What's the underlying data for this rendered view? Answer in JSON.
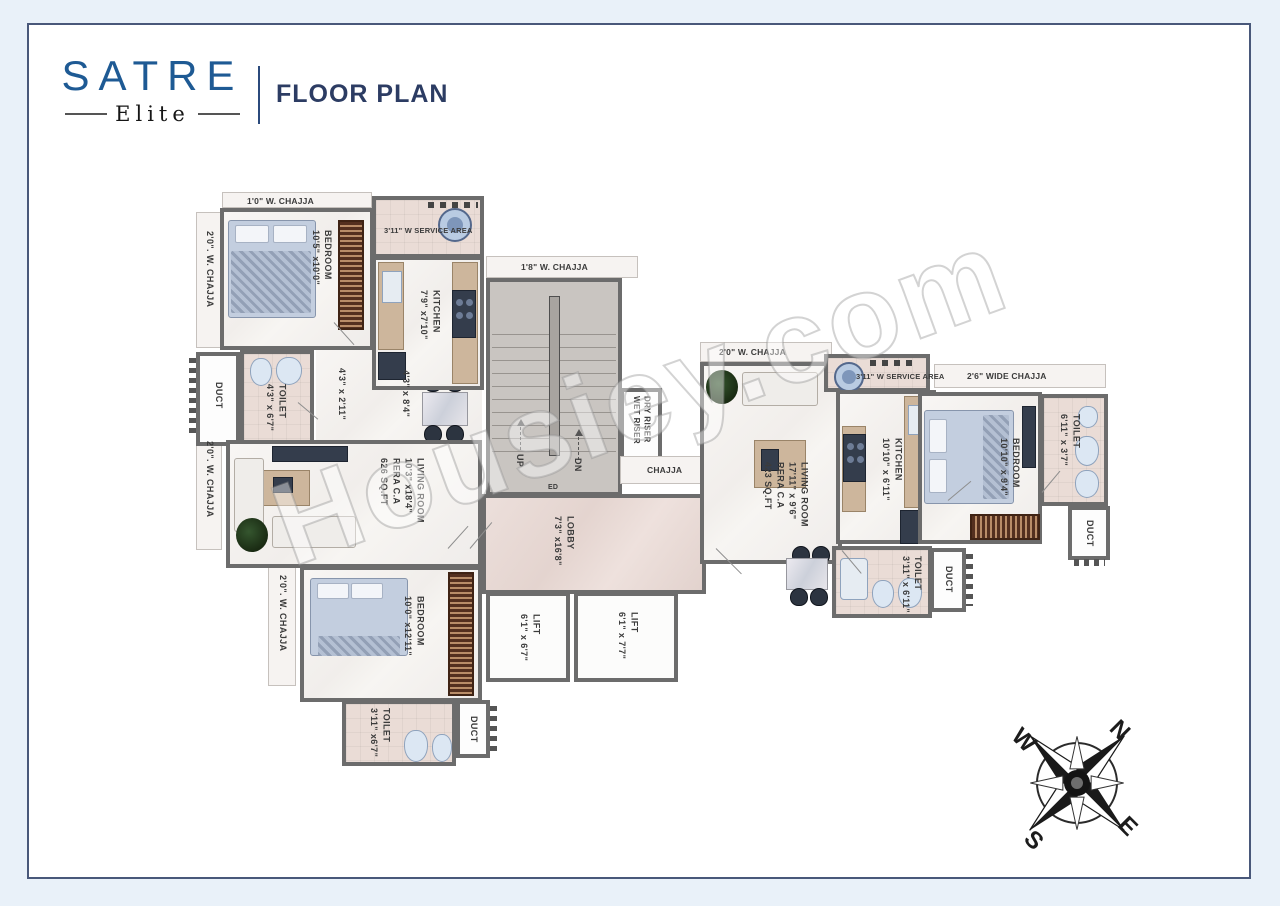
{
  "header": {
    "brand": "SATRE",
    "brand_sub": "Elite",
    "title": "FLOOR PLAN"
  },
  "watermark": "Housiey.com",
  "compass": {
    "north": "N",
    "east": "E",
    "south": "S",
    "west": "W"
  },
  "chajjas": {
    "left_top": "1'0\" W. CHAJJA",
    "left_side_upper": "2'0\". W. CHAJJA",
    "left_side_lower": "2'0\". W. CHAJJA",
    "left_bottom": "2'0\". W. CHAJJA",
    "mid_top": "1'8\" W. CHAJJA",
    "mid_right": "CHAJJA",
    "right_top": "2'0\" W. CHAJJA",
    "right_wide": "2'6\" WIDE CHAJJA"
  },
  "core": {
    "stairs_up": "UP",
    "stairs_dn": "DN",
    "stairs_ed": "ED",
    "riser_line1": "DRY RISER",
    "riser_line2": "WET RISER",
    "lobby": {
      "name": "LOBBY",
      "dims": "7'3\" x16'8\""
    },
    "lift1": {
      "name": "LIFT",
      "dims": "6'1\" x 6'7\""
    },
    "lift2": {
      "name": "LIFT",
      "dims": "6'1\" x 7'7\""
    }
  },
  "unit_left": {
    "service_area": "3'11\" W SERVICE AREA",
    "bedroom1": {
      "name": "BEDROOM",
      "dims": "10'5\" x10'0\""
    },
    "kitchen": {
      "name": "KITCHEN",
      "dims": "7'9\" x7'10\""
    },
    "toilet1": {
      "name": "TOILET",
      "dims": "4'3\" x 6'7\""
    },
    "duct1": "DUCT",
    "passage1": "4'3\" x 2'11\"",
    "passage2": "4'3\" x 8'4\"",
    "living": {
      "name": "LIVING ROOM",
      "dims": "10'3\" x18'4\"",
      "rera": "RERA C.A",
      "area": "626 SQ.FT"
    },
    "bedroom2": {
      "name": "BEDROOM",
      "dims": "10'0\" x12'11\""
    },
    "toilet2": {
      "name": "TOILET",
      "dims": "3'11\" x6'7\""
    },
    "duct2": "DUCT"
  },
  "unit_right": {
    "service_area": "3'11\" W SERVICE AREA",
    "living": {
      "name": "LIVING ROOM",
      "dims": "17'11\" x 9'6\"",
      "rera": "RERA C.A",
      "area": "423 SQ.FT"
    },
    "kitchen": {
      "name": "KITCHEN",
      "dims": "10'10\" x 6'11\""
    },
    "bedroom": {
      "name": "BEDROOM",
      "dims": "10'10\" x 9'4\""
    },
    "toilet1": {
      "name": "TOILET",
      "dims": "6'11\" x 3'7\""
    },
    "duct1": "DUCT",
    "toilet2": {
      "name": "TOILET",
      "dims": "3'11\" x 6'11\""
    },
    "duct2": "DUCT"
  }
}
